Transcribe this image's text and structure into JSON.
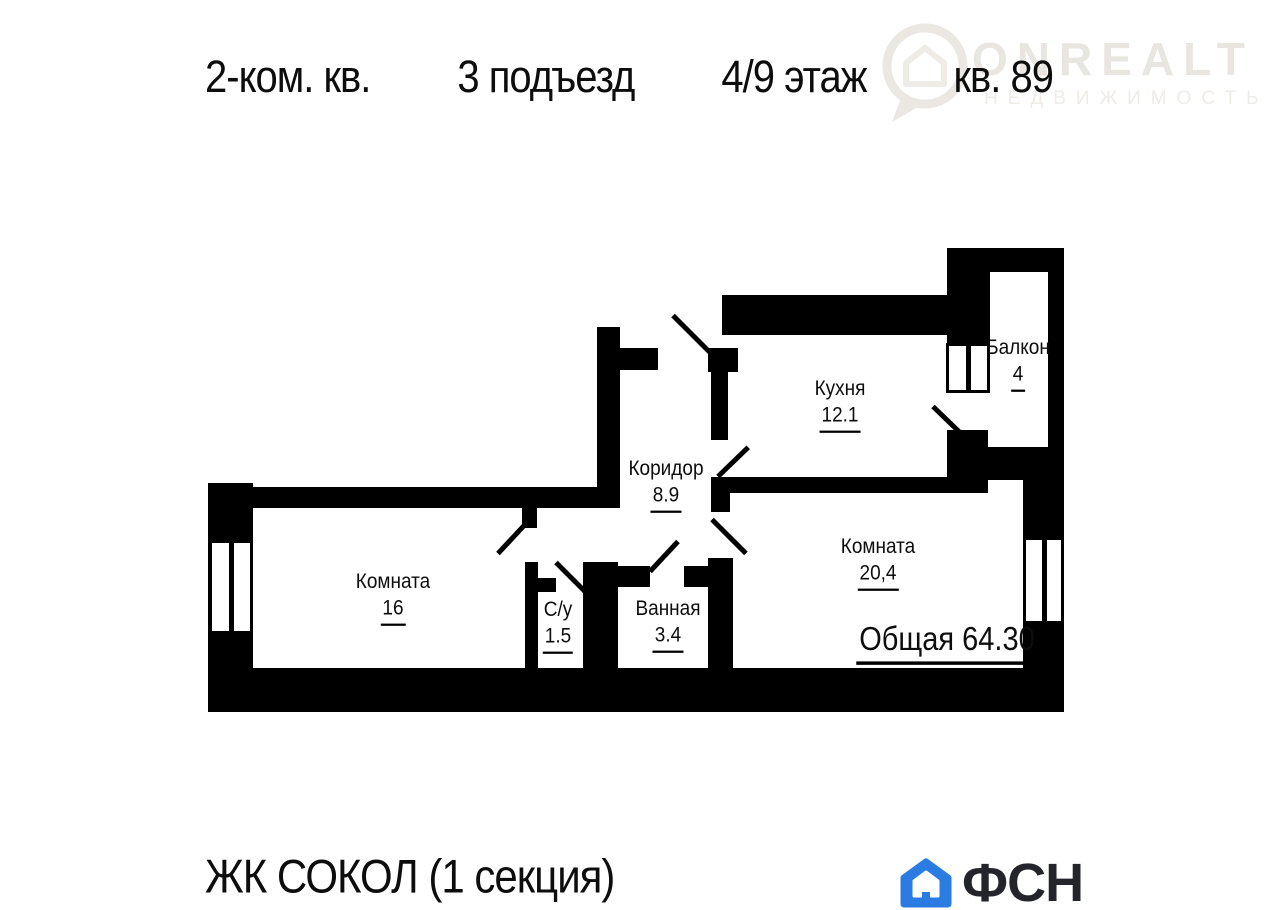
{
  "header": {
    "title_parts": [
      "2-ком. кв.",
      "3 подъезд",
      "4/9 этаж",
      "кв. 89"
    ]
  },
  "watermark": {
    "brand": "ONREALT",
    "tagline": "НЕДВИЖИМОСТЬ"
  },
  "plan": {
    "rooms": [
      {
        "name": "Балкон",
        "area": "4"
      },
      {
        "name": "Кухня",
        "area": "12.1"
      },
      {
        "name": "Коридор",
        "area": "8.9"
      },
      {
        "name": "Комната",
        "area": "16"
      },
      {
        "name": "С/у",
        "area": "1.5"
      },
      {
        "name": "Ванная",
        "area": "3.4"
      },
      {
        "name": "Комната",
        "area": "20,4"
      }
    ],
    "total_label": "Общая 64.30"
  },
  "footer": {
    "project": "ЖК СОКОЛ (1 секция)",
    "logo_text": "ФСН"
  },
  "colors": {
    "wall": "#000000",
    "logo_blue": "#2a7ce2",
    "logo_text": "#23252a",
    "watermark": "#e9e5e0"
  }
}
